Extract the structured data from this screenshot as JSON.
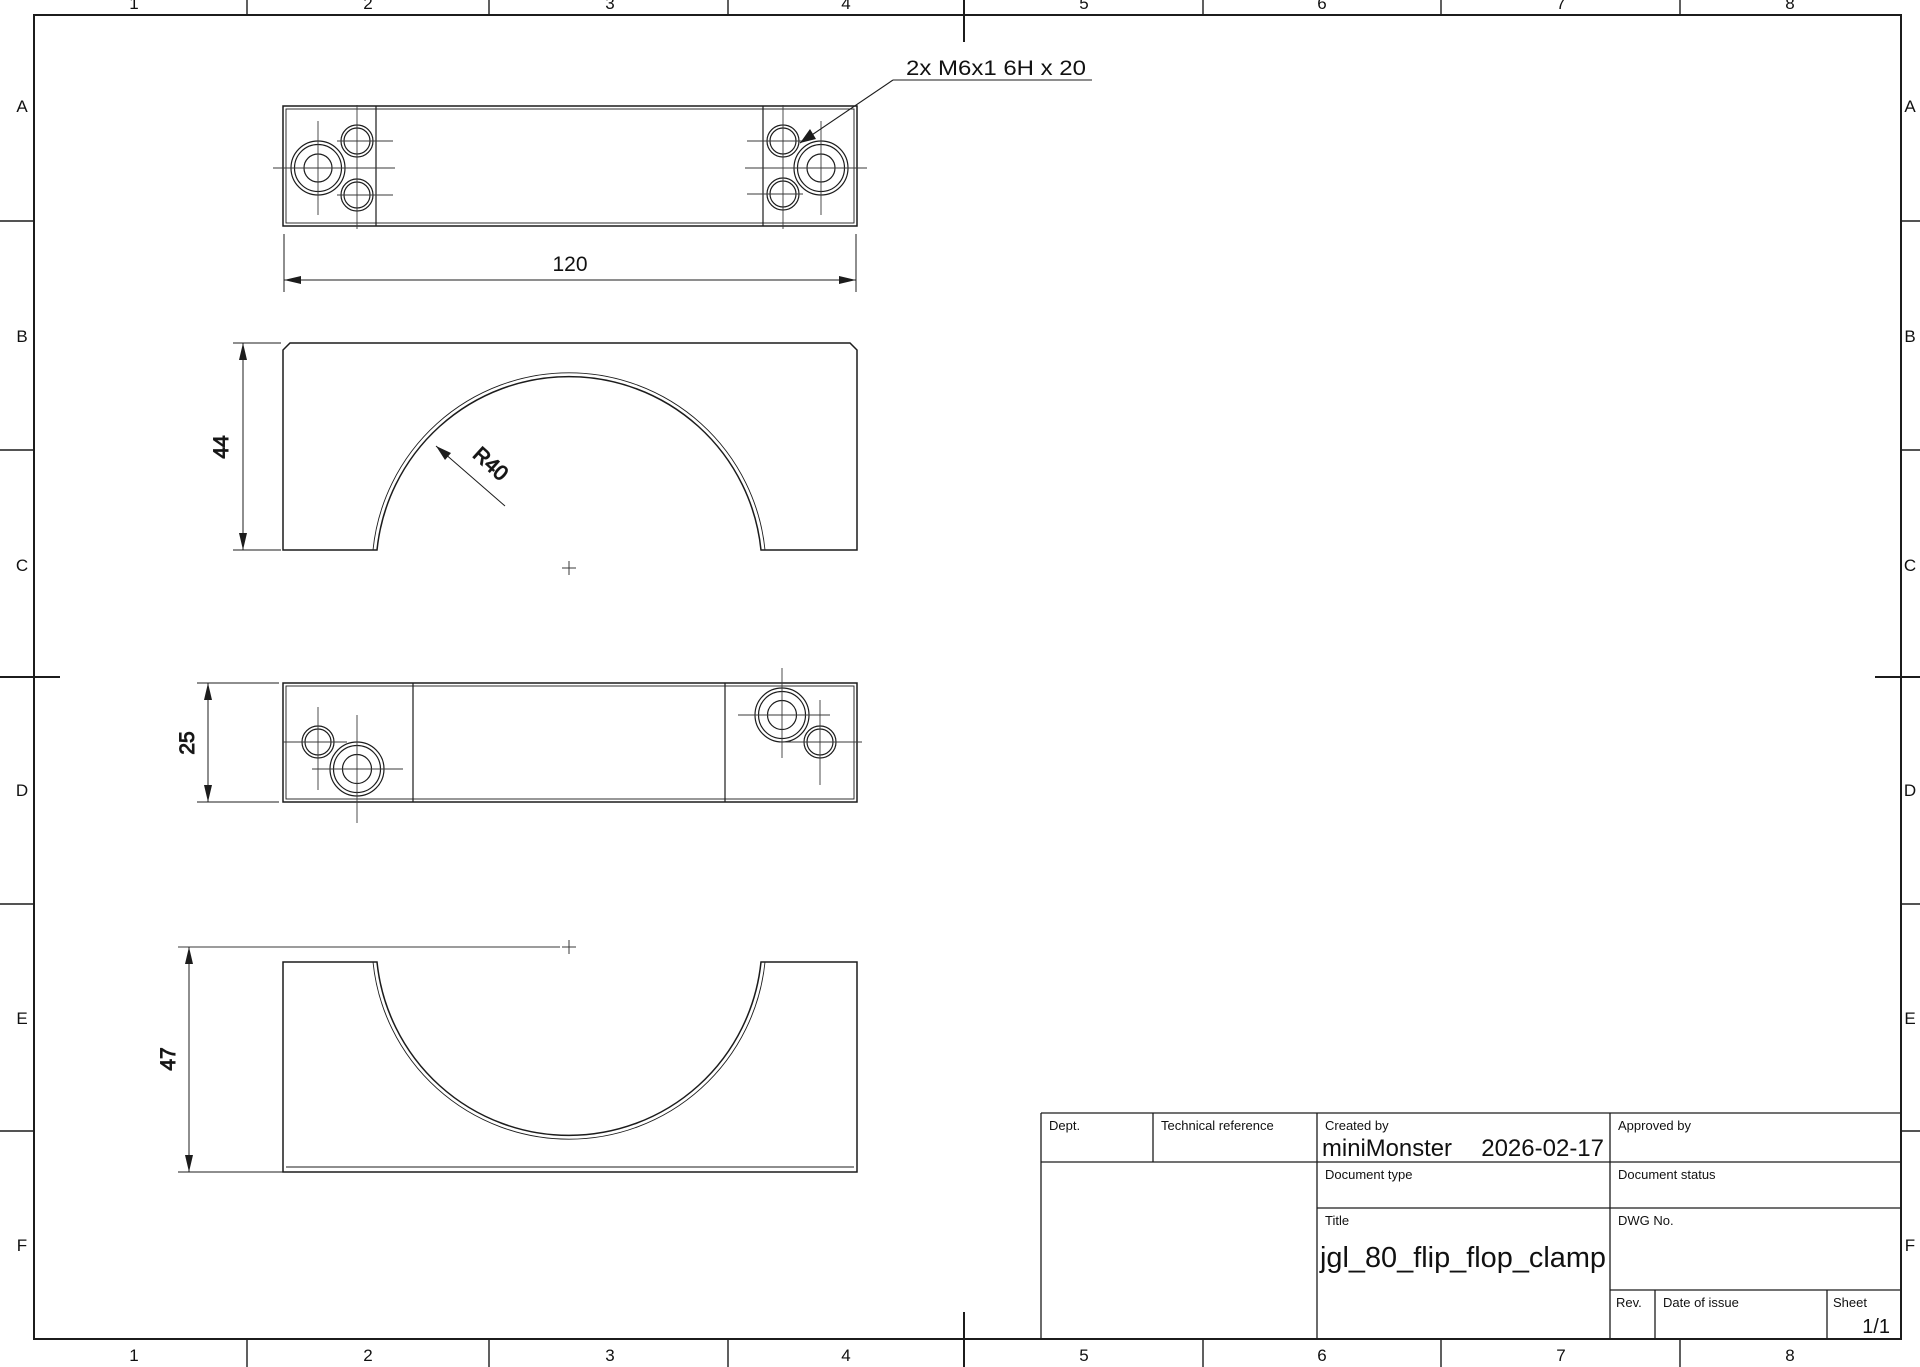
{
  "sheet": {
    "grid_columns": [
      "1",
      "2",
      "3",
      "4",
      "5",
      "6",
      "7",
      "8"
    ],
    "grid_rows": [
      "A",
      "B",
      "C",
      "D",
      "E",
      "F"
    ]
  },
  "drawing": {
    "hole_callout": "2x M6x1 6H x 20",
    "dim_overall_width": "120",
    "dim_front_height": "44",
    "dim_arc_radius": "R40",
    "dim_side_thickness": "25",
    "dim_bottom_height": "47"
  },
  "title_block": {
    "dept_label": "Dept.",
    "technical_reference_label": "Technical reference",
    "created_by_label": "Created by",
    "created_by": "miniMonster",
    "creation_date": "2026-02-17",
    "approved_by_label": "Approved by",
    "document_type_label": "Document type",
    "document_status_label": "Document status",
    "title_label": "Title",
    "title": "jgl_80_flip_flop_clamp",
    "dwg_no_label": "DWG No.",
    "rev_label": "Rev.",
    "date_of_issue_label": "Date of issue",
    "sheet_label": "Sheet",
    "sheet_number": "1/1"
  },
  "colors": {
    "line": "#1c1c1c",
    "thin": "#3a3a3a",
    "background": "#ffffff"
  }
}
